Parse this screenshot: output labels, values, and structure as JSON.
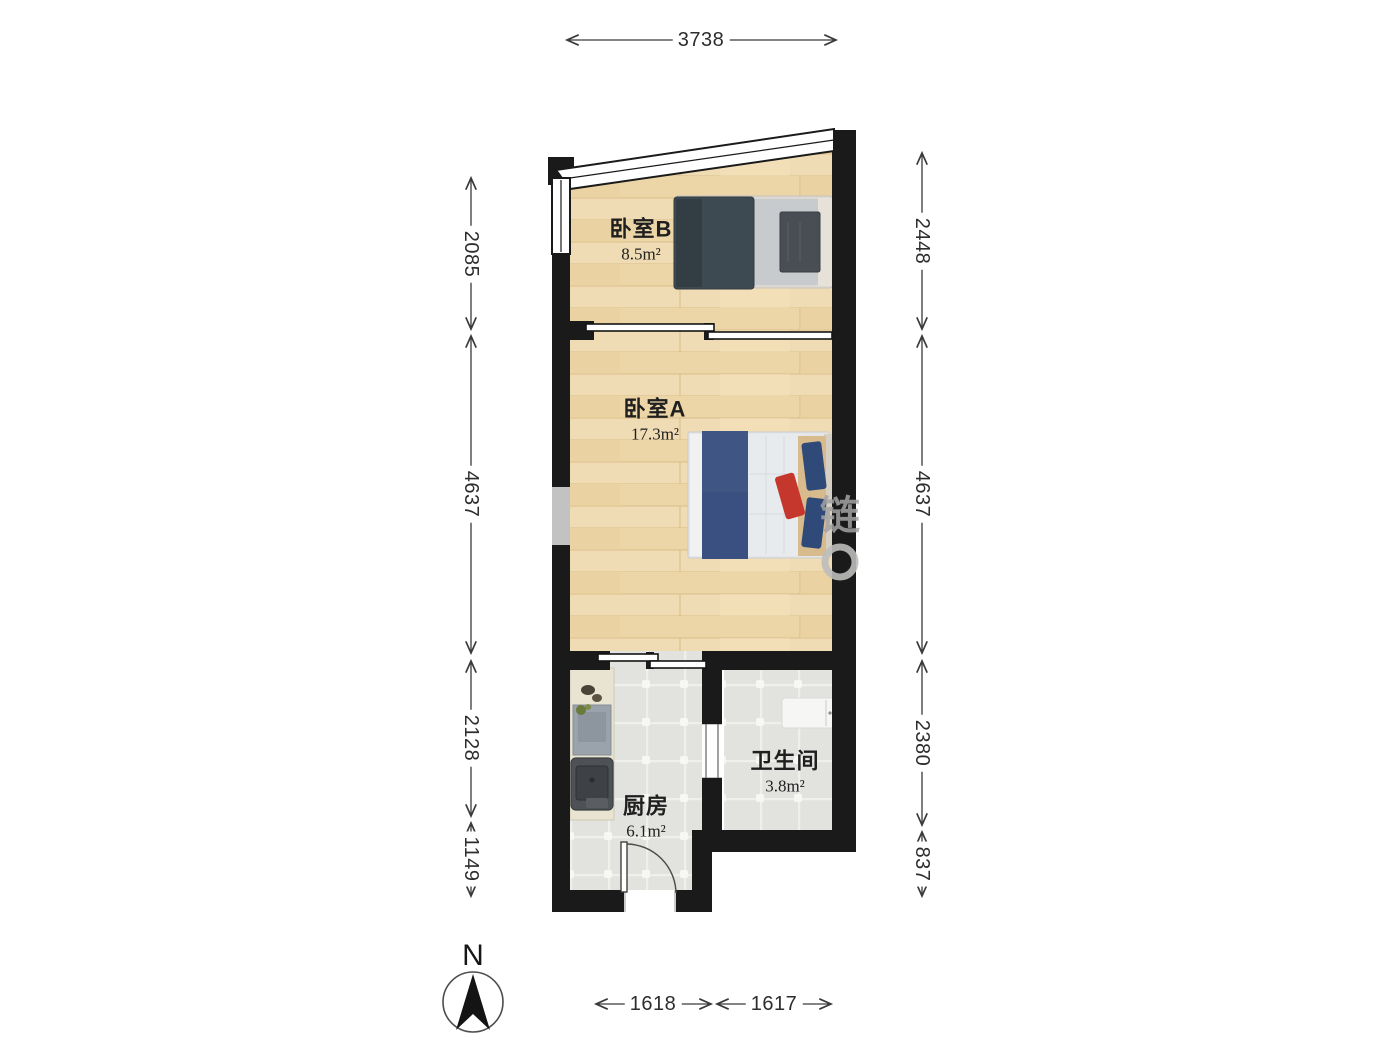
{
  "rooms": [
    {
      "name": "卧室B",
      "area": "8.5m²"
    },
    {
      "name": "卧室A",
      "area": "17.3m²"
    },
    {
      "name": "厨房",
      "area": "6.1m²"
    },
    {
      "name": "卫生间",
      "area": "3.8m²"
    }
  ],
  "dimensions": {
    "top": "3738",
    "left": [
      "2085",
      "4637",
      "2128",
      "1149"
    ],
    "right": [
      "2448",
      "4637",
      "2380",
      "837"
    ],
    "bottom": [
      "1618",
      "1617"
    ]
  },
  "compass": {
    "label": "N"
  },
  "watermark": {
    "text": "链"
  },
  "colors": {
    "wall": "#1a1a1a",
    "wood_floor": "#eed9ae",
    "tile_floor": "#e2e2de",
    "dim_text": "#2d2d2d",
    "bed_navy": "#3f5685",
    "bed_slate": "#3d4a51",
    "accent_red": "#c5372c"
  }
}
